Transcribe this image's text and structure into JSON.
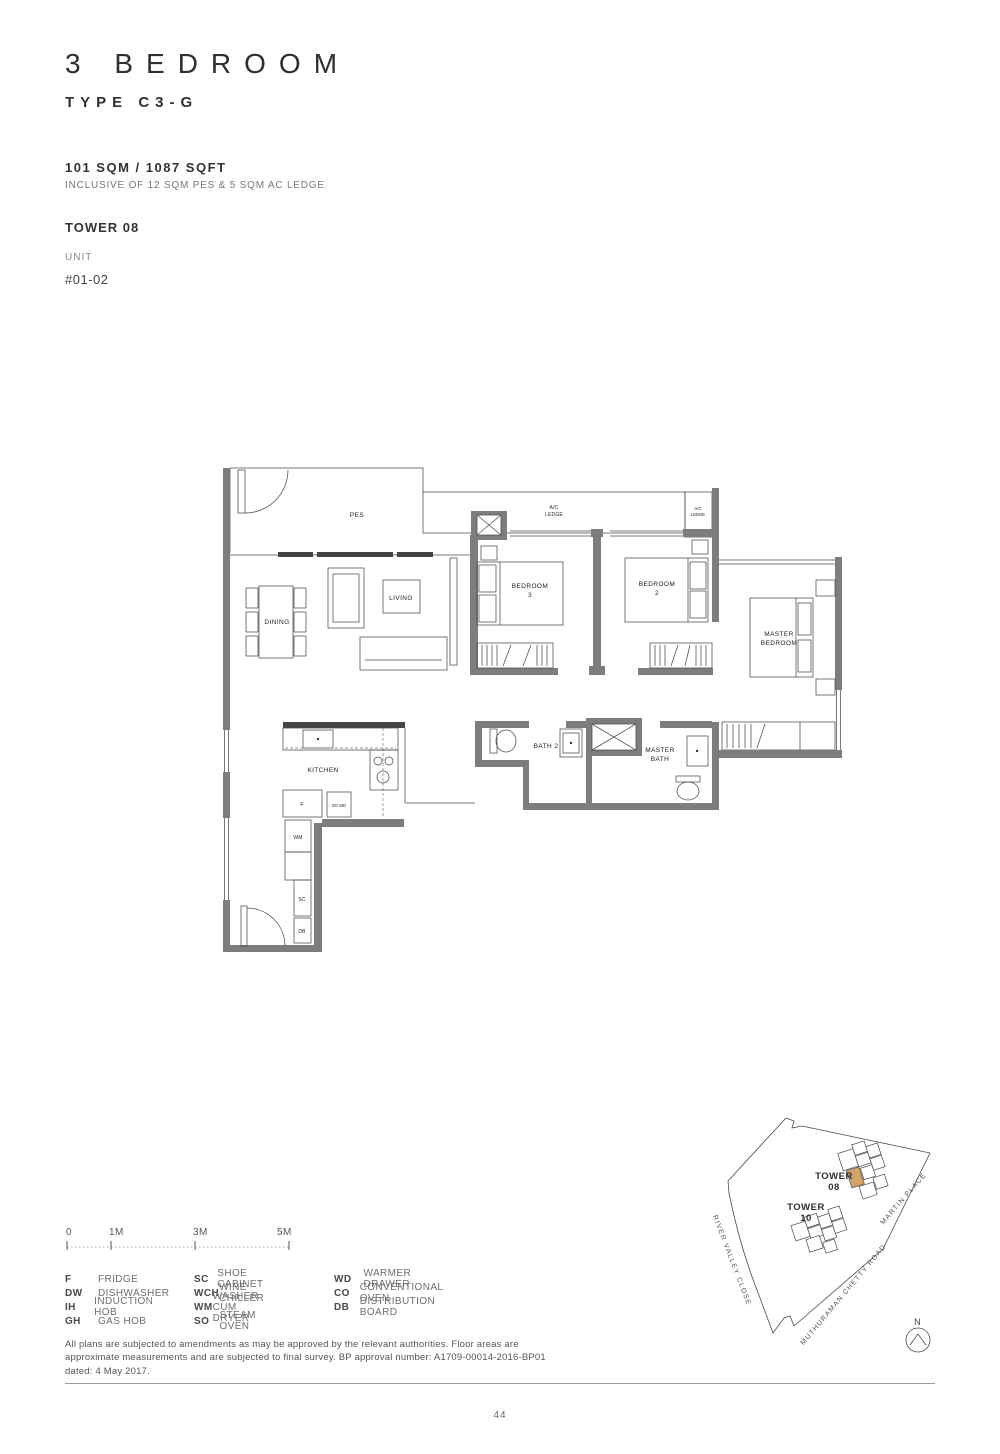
{
  "header": {
    "title": "3 BEDROOM",
    "type": "TYPE C3-G",
    "area": "101 SQM / 1087 SQFT",
    "area_note": "INCLUSIVE OF 12 SQM PES & 5 SQM AC LEDGE",
    "tower": "TOWER 08",
    "unit_label": "UNIT",
    "unit_number": "#01-02"
  },
  "plan": {
    "labels": {
      "pes": "PES",
      "ac_l1": "A/C",
      "ac_l2": "LEDGE",
      "acs_l1": "A/C",
      "acs_l2": "LEDGE",
      "dining": "DINING",
      "living": "LIVING",
      "bed3_l1": "BEDROOM",
      "bed3_l2": "3",
      "bed2_l1": "BEDROOM",
      "bed2_l2": "2",
      "master_l1": "MASTER",
      "master_l2": "BEDROOM",
      "kitchen": "KITCHEN",
      "bath2": "BATH 2",
      "mbath_l1": "MASTER",
      "mbath_l2": "BATH",
      "f": "F",
      "sowd": "SO WD",
      "wm": "WM",
      "sc": "SC",
      "db": "DB"
    }
  },
  "scalebar": {
    "t0": "0",
    "t1": "1M",
    "t2": "3M",
    "t3": "5M"
  },
  "legend": {
    "items": [
      {
        "abbr": "F",
        "label": "FRIDGE"
      },
      {
        "abbr": "DW",
        "label": "DISHWASHER"
      },
      {
        "abbr": "IH",
        "label": "INDUCTION HOB"
      },
      {
        "abbr": "GH",
        "label": "GAS HOB"
      },
      {
        "abbr": "SC",
        "label": "SHOE CABINET"
      },
      {
        "abbr": "WCH",
        "label": "WINE CHILLER"
      },
      {
        "abbr": "WM",
        "label": "WASHER CUM DRYER"
      },
      {
        "abbr": "SO",
        "label": "STEAM OVEN"
      },
      {
        "abbr": "WD",
        "label": "WARMER DRAWER"
      },
      {
        "abbr": "CO",
        "label": "CONVENTIONAL OVEN"
      },
      {
        "abbr": "DB",
        "label": "DISTRIBUTION BOARD"
      }
    ]
  },
  "map": {
    "tower08_l1": "TOWER",
    "tower08_l2": "08",
    "tower10_l1": "TOWER",
    "tower10_l2": "10",
    "street_river": "RIVER VALLEY CLOSE",
    "street_muthuraman": "MUTHURAMAN CHETTY ROAD",
    "street_martin": "MARTIN PLACE",
    "north": "N",
    "highlight_color": "#d2a566"
  },
  "footer": {
    "disclaimer": "All plans are subjected to amendments as may be approved by the relevant authorities. Floor areas are approximate measurements and are subjected to final survey. BP approval number: A1709-00014-2016-BP01 dated: 4 May 2017.",
    "page": "44"
  }
}
